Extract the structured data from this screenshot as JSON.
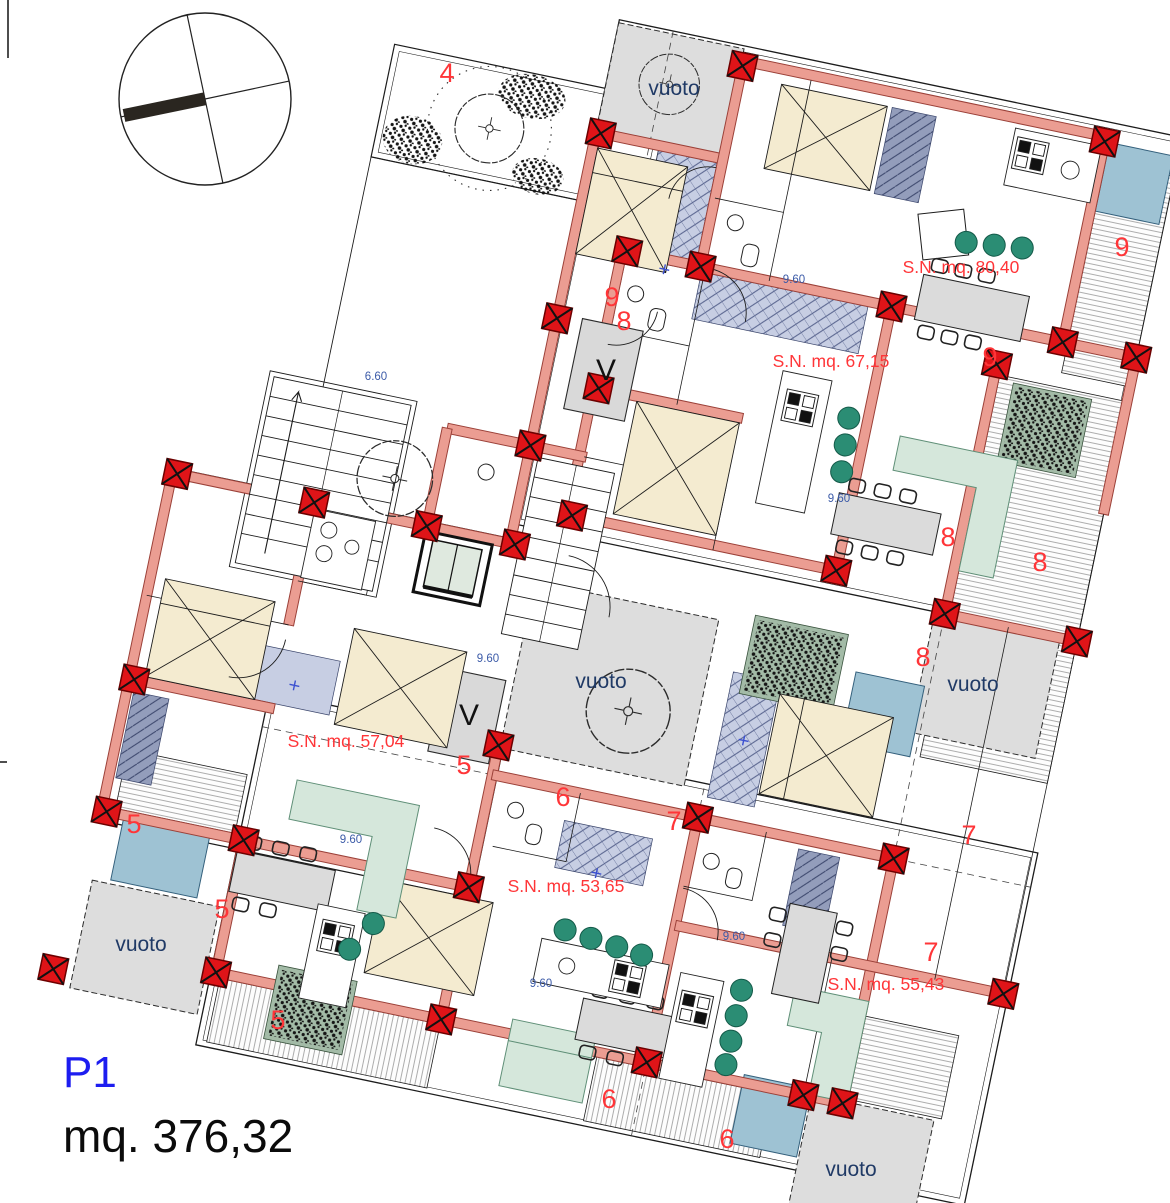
{
  "title": {
    "floor_label": "P1",
    "total_area_label": "mq. 376,32"
  },
  "plan": {
    "area_labels": [
      {
        "text": "S.N. mq. 80,40"
      },
      {
        "text": "S.N. mq. 67,15"
      },
      {
        "text": "S.N. mq. 57,04"
      },
      {
        "text": "S.N. mq. 53,65"
      },
      {
        "text": "S.N. mq. 55,43"
      }
    ],
    "void_labels": [
      {
        "text": "vuoto"
      },
      {
        "text": "vuoto"
      },
      {
        "text": "vuoto"
      },
      {
        "text": "vuoto"
      },
      {
        "text": "vuoto"
      }
    ],
    "grid_labels": [
      {
        "text": "4"
      },
      {
        "text": "9"
      },
      {
        "text": "8"
      },
      {
        "text": "9"
      },
      {
        "text": "9"
      },
      {
        "text": "8"
      },
      {
        "text": "8"
      },
      {
        "text": "8"
      },
      {
        "text": "5"
      },
      {
        "text": "5"
      },
      {
        "text": "5"
      },
      {
        "text": "5"
      },
      {
        "text": "6"
      },
      {
        "text": "6"
      },
      {
        "text": "6"
      },
      {
        "text": "7"
      },
      {
        "text": "7"
      },
      {
        "text": "7"
      }
    ],
    "dimension_labels": [
      {
        "text": "6.60"
      },
      {
        "text": "9.60"
      },
      {
        "text": "9.60"
      },
      {
        "text": "9.60"
      },
      {
        "text": "9.60"
      },
      {
        "text": "9.60"
      },
      {
        "text": "9.60"
      }
    ],
    "elevator_labels": [
      {
        "text": "V"
      },
      {
        "text": "V"
      }
    ]
  },
  "colors": {
    "wall_fill": "#eb9d92",
    "wall_edge": "#9b4038",
    "column_red": "#df1418",
    "void_gray": "#dddddd",
    "bed_beige": "#f4ebd0",
    "sofa_green": "#d5e7db",
    "skylight_blue": "#9ec2d3",
    "loggia_lavender": "#c7cee3",
    "wardrobe_slate": "#939dbb",
    "stool_green": "#2b8d74",
    "table_gray": "#dbdbdb",
    "planter_green": "#a3bba7",
    "label_red": "#ff3538",
    "label_navy": "#203a66",
    "dim_blue": "#3c5ba8",
    "floor_blue": "#1d1df0"
  }
}
